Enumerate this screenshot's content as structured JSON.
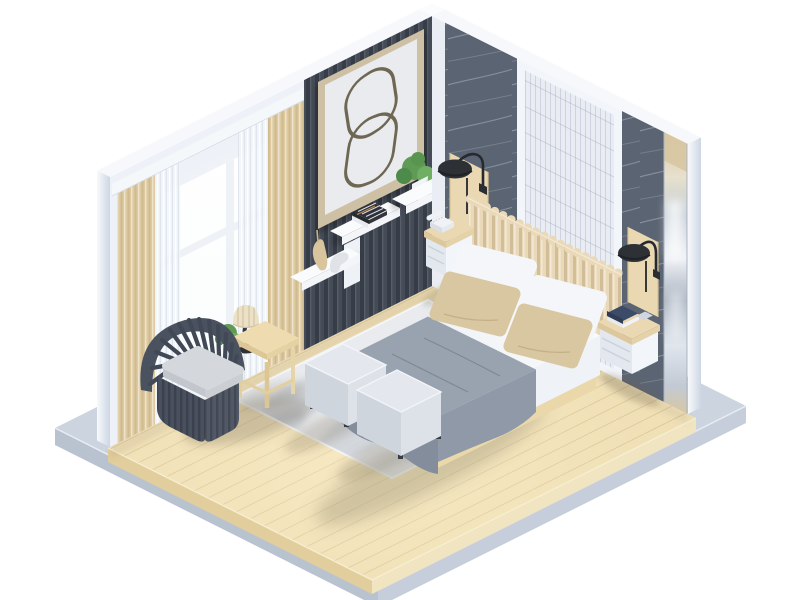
{
  "canvas": {
    "width": 800,
    "height": 600,
    "background": "#ffffff"
  },
  "scene": {
    "type": "3d-isometric-render",
    "subject": "modern bedroom interior cutaway",
    "view": "isometric",
    "objects": [
      "concrete base platform",
      "wood plank floor",
      "window wall with beige and sheer curtains",
      "dark slatted accent wall",
      "abstract line wall art",
      "floating shelf with books and vases",
      "wall shelf with potted plant",
      "dark marble wall panels",
      "white paneled wall",
      "vertical mirror strip",
      "channel-tufted headboard",
      "double bed with white duvet and gray throw blanket",
      "white and beige pillows",
      "two black wall sconce lamps",
      "two floating nightstands",
      "white telephone",
      "stacked decor books",
      "two white cube ottomans",
      "gray patterned area rug",
      "slatted barrel armchair with gray cushion",
      "wooden side table",
      "pleated table lamp",
      "potted plants"
    ]
  },
  "colors": {
    "background": "#ffffff",
    "platform_top": "#ccd4df",
    "platform_left": "#b9c3d0",
    "platform_right": "#c6cedb",
    "floor_top": "#eeddb2",
    "floor_left": "#e2cd9c",
    "floor_right": "#f1e4c0",
    "wall_white": "#eef2f8",
    "wall_top_strip": "#f6f8fb",
    "window_frame": "#eff3f8",
    "curtain_beige": "#decaa1",
    "curtain_sheer": "#f1f4f9",
    "slat_wall": "#454c58",
    "art_frame": "#cec0a5",
    "art_mat": "#e9ebee",
    "art_line": "#6e6753",
    "shelf_white": "#f3f5f9",
    "vase_tan": "#d9c59d",
    "vase_gray": "#dfe3e8",
    "marble": "#5b6472",
    "panel_white": "#e9edf3",
    "panel_frame": "#f2f5f9",
    "wood_accent": "#e9d8b2",
    "mirror_warm": "#d8c7a2",
    "sconce_black": "#2d3136",
    "headboard": "#e9d9b9",
    "duvet_white": "#f3f5f8",
    "bed_side": "#e9edf2",
    "blanket": "#99a2af",
    "blanket_dark": "#848d9b",
    "pillow_white": "#f4f6f9",
    "pillow_beige": "#d9c7a2",
    "bed_base_wood": "#e3cfa0",
    "nightstand_white": "#f2f5f9",
    "ottoman_top": "#e4e8ee",
    "ottoman_left": "#cfd5dd",
    "ottoman_right": "#dde1e8",
    "rug": "#e9ebee",
    "rug_pattern": "#c7ccd3",
    "chair_body": "#4a5260",
    "chair_base": "#49505e",
    "cushion": "#d4d7db",
    "table_wood": "#eedcb0",
    "lamp_shade": "#ece1c6",
    "lamp_black": "#2e3237",
    "plant_green": "#5f9b55",
    "phone_white": "#f0f2f5",
    "book_navy": "#3c4c68",
    "book_dark": "#2e3137"
  }
}
